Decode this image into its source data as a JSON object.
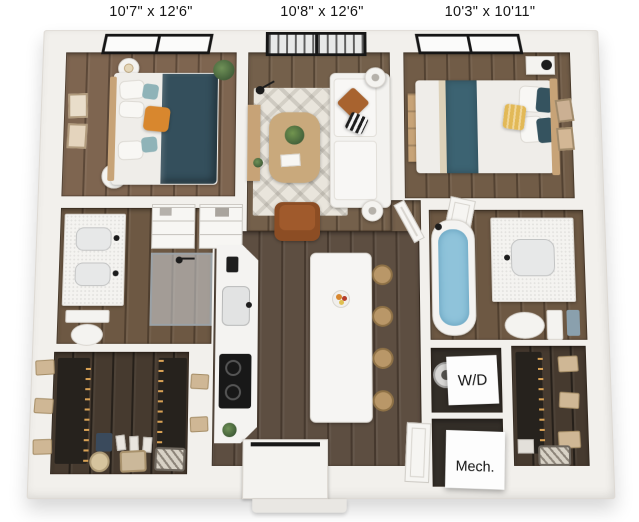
{
  "floorplan": {
    "dimension_labels": [
      {
        "room": "bedroom-left",
        "text": "10'7\" x 12'6\""
      },
      {
        "room": "living-room",
        "text": "10'8\" x 12'6\""
      },
      {
        "room": "bedroom-right",
        "text": "10'3\" x 10'11\""
      }
    ],
    "closet_labels": {
      "washer_dryer": "W/D",
      "mechanical": "Mech."
    },
    "colors": {
      "wall": "#f2f0ec",
      "wood_floor": "#6a5745",
      "wood_floor_dark": "#46392e",
      "duvet_teal": "#344f5c",
      "throw_teal": "#3c6372",
      "pillow_orange": "#d8872e",
      "pillow_yellow": "#e2b957",
      "leather_chair": "#a05a2c",
      "tub_water": "#8fc3da",
      "window_frame": "#161616",
      "label_text": "#161616"
    }
  }
}
